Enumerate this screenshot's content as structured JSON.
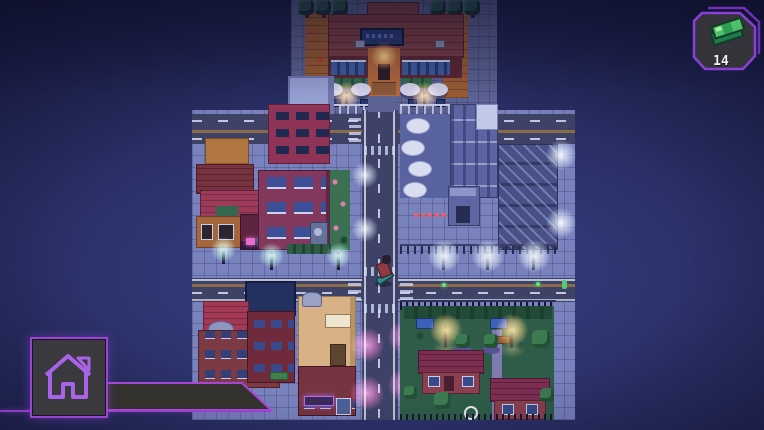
{
  "hud": {
    "money_badge": {
      "value": "14",
      "icon": "cash-stack-icon",
      "border_color": "#8a3fd9",
      "panel_color": "#35343a",
      "bill_color": "#4fc06a"
    },
    "home_button": {
      "icon": "home-icon",
      "border_color": "#9a45d2",
      "panel_color": "#3a393e"
    },
    "bottom_bar": {
      "fill_color": "#33322e",
      "border_color": "#a845d6"
    }
  },
  "scene": {
    "type": "top-down pixel-art city at night",
    "player": "character on skateboard at the central crosswalk"
  }
}
